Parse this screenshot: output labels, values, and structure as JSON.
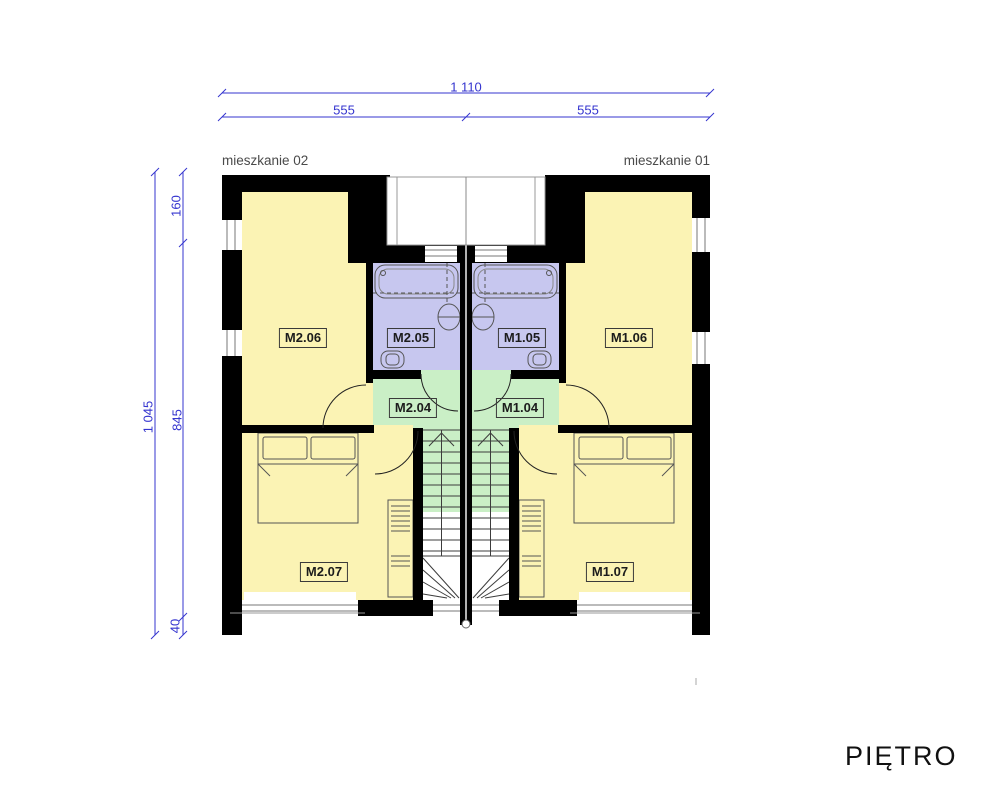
{
  "title": "PIĘTRO",
  "apartment_labels": {
    "left": "mieszkanie 02",
    "right": "mieszkanie 01"
  },
  "dimensions_top": {
    "total": "1 110",
    "left": "555",
    "right": "555"
  },
  "dimensions_side": {
    "total": "1 045",
    "upper": "160",
    "middle": "845",
    "lower": "40"
  },
  "rooms": [
    {
      "label": "M2.06"
    },
    {
      "label": "M2.05"
    },
    {
      "label": "M1.05"
    },
    {
      "label": "M1.06"
    },
    {
      "label": "M2.04"
    },
    {
      "label": "M1.04"
    },
    {
      "label": "M2.07"
    },
    {
      "label": "M1.07"
    }
  ],
  "colors": {
    "room_fill": "#FBF3B4",
    "bathroom_fill": "#C7C7EF",
    "hall_fill": "#CAEFC6",
    "wall": "#000000",
    "dimension": "#3535CF"
  }
}
